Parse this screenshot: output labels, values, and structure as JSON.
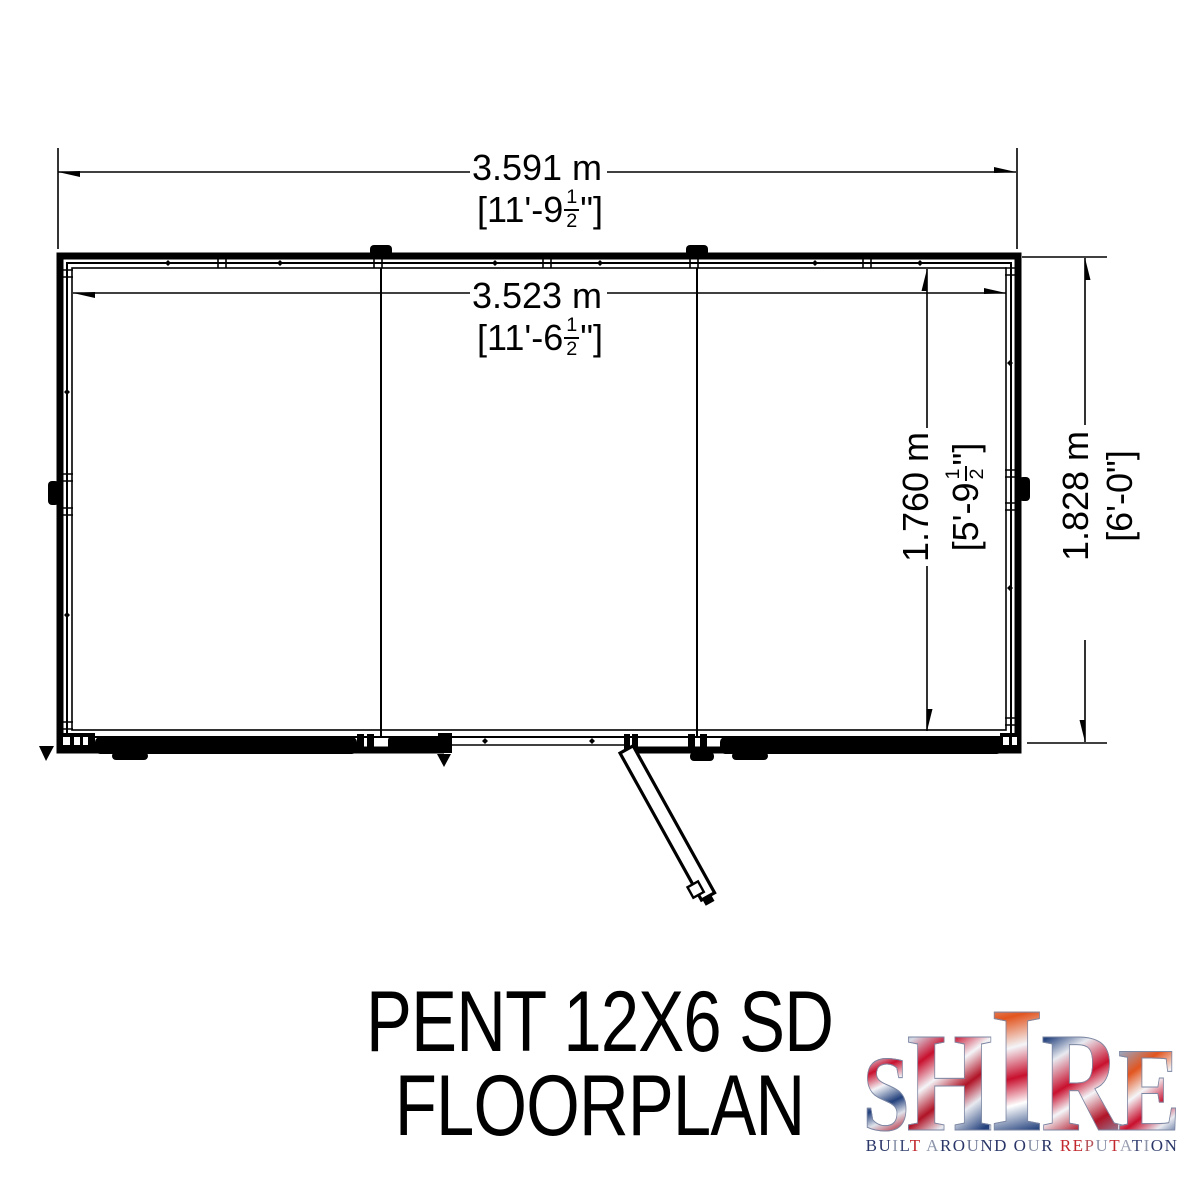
{
  "title": {
    "line1": "PENT 12X6 SD",
    "line2": "FLOORPLAN"
  },
  "dimensions": {
    "outer_width": {
      "metric": "3.591 m",
      "imp_prefix": "[11'-9",
      "frac_num": "1",
      "frac_den": "2",
      "imp_suffix": "\"]"
    },
    "inner_width": {
      "metric": "3.523 m",
      "imp_prefix": "[11'-6",
      "frac_num": "1",
      "frac_den": "2",
      "imp_suffix": "\"]"
    },
    "inner_depth": {
      "metric": "1.760 m",
      "imp_prefix": "[5'-9",
      "frac_num": "1",
      "frac_den": "2",
      "imp_suffix": "\"]"
    },
    "outer_depth": {
      "metric": "1.828 m",
      "imp_prefix": "[6'-0",
      "frac_num": "",
      "frac_den": "",
      "imp_suffix": "\"]"
    }
  },
  "logo": {
    "brand": "SHIRE",
    "brand_letters": [
      {
        "ch": "S",
        "size": 108,
        "grad": "g0"
      },
      {
        "ch": "H",
        "size": 142,
        "grad": "g1"
      },
      {
        "ch": "I",
        "size": 180,
        "grad": "g2"
      },
      {
        "ch": "R",
        "size": 142,
        "grad": "g3"
      },
      {
        "ch": "E",
        "size": 120,
        "grad": "g4"
      }
    ],
    "tagline": "BUILT AROUND OUR REPUTATION",
    "tagline_letters": [
      {
        "ch": "B",
        "color": "#2a3668"
      },
      {
        "ch": "U",
        "color": "#2a3668"
      },
      {
        "ch": "I",
        "color": "#8a93a8"
      },
      {
        "ch": "L",
        "color": "#3a4674"
      },
      {
        "ch": "T",
        "color": "#c1272d"
      },
      {
        "ch": " "
      },
      {
        "ch": "A",
        "color": "#8a93a8"
      },
      {
        "ch": "R",
        "color": "#2a3668"
      },
      {
        "ch": "O",
        "color": "#2a3668"
      },
      {
        "ch": "U",
        "color": "#6b7594"
      },
      {
        "ch": "N",
        "color": "#2a3668"
      },
      {
        "ch": "D",
        "color": "#2a3668"
      },
      {
        "ch": " "
      },
      {
        "ch": "O",
        "color": "#2a3668"
      },
      {
        "ch": "U",
        "color": "#8a93a8"
      },
      {
        "ch": "R",
        "color": "#2a3668"
      },
      {
        "ch": " "
      },
      {
        "ch": "R",
        "color": "#c1272d"
      },
      {
        "ch": "E",
        "color": "#c1272d"
      },
      {
        "ch": "P",
        "color": "#b5535a"
      },
      {
        "ch": "U",
        "color": "#8a93a8"
      },
      {
        "ch": "T",
        "color": "#c1272d"
      },
      {
        "ch": "A",
        "color": "#9aa0b2"
      },
      {
        "ch": "T",
        "color": "#3a4674"
      },
      {
        "ch": "I",
        "color": "#8a93a8"
      },
      {
        "ch": "O",
        "color": "#2a3668"
      },
      {
        "ch": "N",
        "color": "#2a3668"
      }
    ],
    "colors": {
      "navy": "#2a3668",
      "red": "#c1272d",
      "silver": "#8a93a8"
    }
  }
}
